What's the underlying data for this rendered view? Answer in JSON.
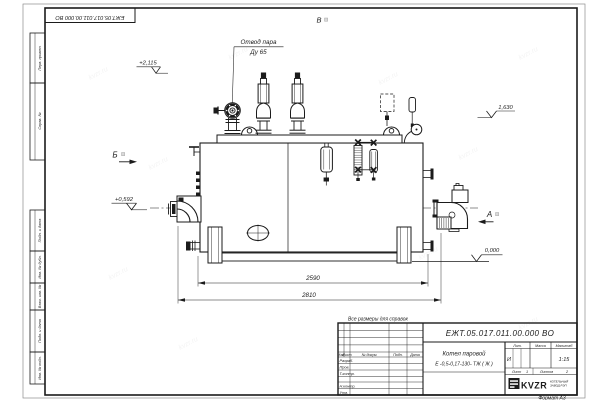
{
  "sheet": {
    "doc_number_top": "ЕЖТ.05.017.011.00.000  ВО",
    "format_note": "Формат А3",
    "dimensions_note": "Все размеры для справок",
    "watermark": "kvzr.ru"
  },
  "margin_stamps": {
    "perv_primen": "Перв. примен.",
    "sprav_no": "Справ. №",
    "podp_data_1": "Подп. и дата",
    "inv_dubl": "Инв. № дубл.",
    "vzam_inv": "Взам. инв. №",
    "podp_data_2": "Подп. и дата",
    "inv_podl": "Инв. № подл."
  },
  "drawing": {
    "labels": {
      "steam_outlet": "Отвод пара",
      "steam_outlet_size": "Ду 65",
      "view_v": "В",
      "view_b": "Б",
      "view_a": "А"
    },
    "elevations": {
      "valve_top": "+2,115",
      "upper_right": "1,630",
      "pump_axis": "+0,592",
      "ground": "0,000"
    },
    "dims": {
      "inner": "2590",
      "outer": "2810"
    }
  },
  "title_block": {
    "doc_number": "ЕЖТ.05.017.011.00.000  ВО",
    "name_line1": "Котел паровой",
    "name_line2": "Е -0,5-0,17-130- ТЖ ( Ж )",
    "cols": {
      "izm": "Изм",
      "list": "Лист",
      "doc": "№ докум.",
      "podp": "Подп.",
      "data": "Дата"
    },
    "rows": {
      "razrab": "Разраб.",
      "prov": "Пров.",
      "tkontr": "Т.контр.",
      "nkontr": "Н.контр.",
      "utv": "Утв."
    },
    "lit": {
      "header": "Лит.",
      "value": "И"
    },
    "massa": {
      "header": "Масса"
    },
    "scale": {
      "header": "Масштаб",
      "value": "1:15"
    },
    "sheet_no": {
      "label": "Лист",
      "value": "1"
    },
    "sheets_total": {
      "label": "Листов",
      "value": "2"
    },
    "logo": {
      "text": "KVZR",
      "caption1": "КОТЕЛЬНЫЙ",
      "caption2": "ЗАВОД РЭП"
    }
  }
}
